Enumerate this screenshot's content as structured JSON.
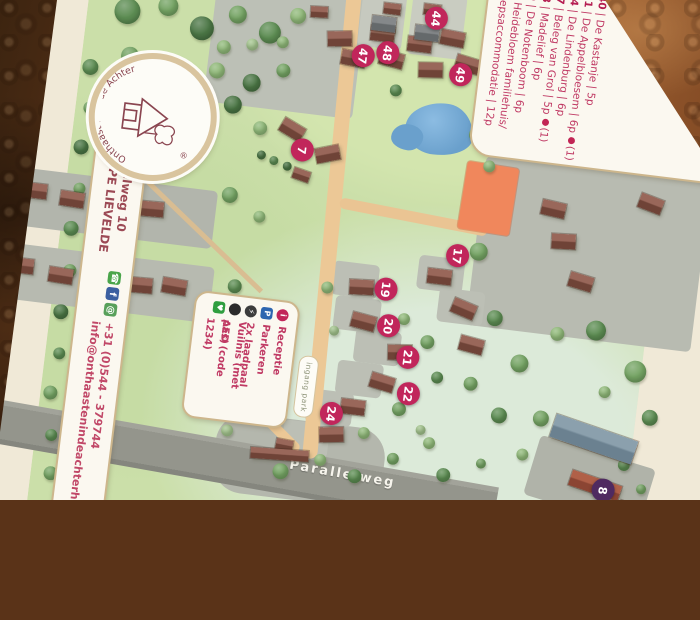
{
  "photo": {
    "surface": "copper leather table"
  },
  "branding": {
    "logo_arc_text": "Onthaast'n in' de Achterhoek",
    "registered_mark": "®"
  },
  "address": {
    "street": "Parallelweg 10",
    "postal_city": "7137 PE LIEVELDE",
    "phone": "+31 (0)544 - 379744",
    "email": "info@onthaastenindeachterhoek.nl"
  },
  "accommodations_legend": {
    "items": [
      {
        "num": "40",
        "name": "De Kastanje",
        "capacity": "5p",
        "pet": false,
        "pet_note": ""
      },
      {
        "num": "41",
        "name": "De Appelbloesem",
        "capacity": "6p",
        "pet": true,
        "pet_note": "(1)"
      },
      {
        "num": "44",
        "name": "De Lindenburg",
        "capacity": "6p",
        "pet": false,
        "pet_note": ""
      },
      {
        "num": "47",
        "name": "Beleg van Grol",
        "capacity": "5p",
        "pet": true,
        "pet_note": "(1)"
      },
      {
        "num": "48",
        "name": "Madelief",
        "capacity": "6p",
        "pet": false,
        "pet_note": ""
      },
      {
        "num": "49",
        "name": "De Notenboom",
        "capacity": "6p",
        "pet": false,
        "pet_note": ""
      },
      {
        "num": "8",
        "name": "Heidebloem familiehuis/ groepsaccommodatie",
        "capacity": "12p",
        "pet": false,
        "pet_note": ""
      }
    ]
  },
  "facilities_legend": {
    "items": [
      {
        "icon": "info-icon",
        "glyph": "i",
        "shape": "circle",
        "color": "#c2265a",
        "label": "Receptie"
      },
      {
        "icon": "parking-icon",
        "glyph": "P",
        "shape": "square",
        "color": "#2e66b0",
        "label": "Parkeren"
      },
      {
        "icon": "ev-charger-icon",
        "glyph": "⚡",
        "shape": "circle",
        "color": "#3c3c3c",
        "label": "2x laadpaal"
      },
      {
        "icon": "trash-icon",
        "glyph": "",
        "shape": "circle",
        "color": "#2b2b2b",
        "label": "Vuilnis (met pas)"
      },
      {
        "icon": "aed-icon",
        "glyph": "♥",
        "shape": "square",
        "color": "#2f9e3f",
        "label": "AED (code 1234)"
      }
    ]
  },
  "map": {
    "road_label": "Parallelweg",
    "entrance_label": "ingang park",
    "marker_color": "#c1265b",
    "marker_8_color": "#4f2a60",
    "markers": [
      {
        "n": "44",
        "x": 407,
        "y": 9
      },
      {
        "n": "47",
        "x": 339,
        "y": 55
      },
      {
        "n": "48",
        "x": 363,
        "y": 49
      },
      {
        "n": "49",
        "x": 438,
        "y": 62
      },
      {
        "n": "7",
        "x": 290,
        "y": 156
      },
      {
        "n": "17",
        "x": 457,
        "y": 242
      },
      {
        "n": "19",
        "x": 390,
        "y": 284
      },
      {
        "n": "20",
        "x": 397,
        "y": 320
      },
      {
        "n": "21",
        "x": 420,
        "y": 349
      },
      {
        "n": "22",
        "x": 425,
        "y": 385
      },
      {
        "n": "24",
        "x": 351,
        "y": 414
      },
      {
        "n": "8",
        "x": 630,
        "y": 457,
        "purple": true
      }
    ],
    "houses": [
      [
        302,
        34,
        -8,
        ""
      ],
      [
        318,
        52,
        4,
        ""
      ],
      [
        344,
        24,
        0,
        ""
      ],
      [
        356,
        48,
        8,
        ""
      ],
      [
        382,
        30,
        0,
        ""
      ],
      [
        396,
        54,
        -6,
        ""
      ],
      [
        414,
        20,
        4,
        ""
      ],
      [
        354,
        0,
        0,
        "small"
      ],
      [
        394,
        -4,
        0,
        "small"
      ],
      [
        432,
        44,
        10,
        ""
      ],
      [
        282,
        12,
        -4,
        "small"
      ],
      [
        344,
        14,
        0,
        "shed"
      ],
      [
        388,
        18,
        0,
        "shed"
      ],
      [
        266,
        130,
        24,
        ""
      ],
      [
        304,
        150,
        -18,
        ""
      ],
      [
        284,
        176,
        12,
        "small"
      ],
      [
        18,
        222,
        0,
        ""
      ],
      [
        56,
        226,
        2,
        ""
      ],
      [
        96,
        229,
        0,
        ""
      ],
      [
        136,
        226,
        -2,
        ""
      ],
      [
        14,
        298,
        0,
        ""
      ],
      [
        54,
        303,
        2,
        ""
      ],
      [
        94,
        306,
        0,
        ""
      ],
      [
        134,
        303,
        -2,
        ""
      ],
      [
        168,
        300,
        3,
        ""
      ],
      [
        527,
        12,
        0,
        ""
      ],
      [
        560,
        40,
        6,
        ""
      ],
      [
        594,
        99,
        4,
        ""
      ],
      [
        535,
        177,
        6,
        ""
      ],
      [
        549,
        208,
        -4,
        ""
      ],
      [
        571,
        246,
        10,
        ""
      ],
      [
        631,
        160,
        14,
        ""
      ],
      [
        354,
        278,
        -4,
        ""
      ],
      [
        360,
        312,
        8,
        ""
      ],
      [
        400,
        338,
        -6,
        ""
      ],
      [
        386,
        370,
        10,
        ""
      ],
      [
        360,
        398,
        0,
        ""
      ],
      [
        342,
        428,
        -8,
        ""
      ],
      [
        300,
        446,
        4,
        "small"
      ],
      [
        430,
        258,
        0,
        ""
      ],
      [
        458,
        287,
        16,
        ""
      ],
      [
        470,
        322,
        8,
        ""
      ],
      [
        276,
        456,
        -3,
        "long"
      ],
      [
        572,
        396,
        12,
        "barn"
      ],
      [
        596,
        446,
        12,
        "red"
      ],
      [
        648,
        468,
        12,
        "red2"
      ]
    ],
    "tree_palette": [
      "#8fb878",
      "#74a363",
      "#5c8c52",
      "#4a7544",
      "#a3c48d"
    ],
    "trees": [
      [
        70,
        100,
        16,
        2
      ],
      [
        74,
        140,
        13,
        1
      ],
      [
        70,
        180,
        15,
        3
      ],
      [
        74,
        222,
        12,
        1
      ],
      [
        70,
        262,
        15,
        2
      ],
      [
        74,
        304,
        13,
        1
      ],
      [
        70,
        346,
        15,
        3
      ],
      [
        74,
        388,
        12,
        2
      ],
      [
        70,
        428,
        14,
        1
      ],
      [
        76,
        470,
        12,
        2
      ],
      [
        80,
        508,
        14,
        1
      ],
      [
        100,
        40,
        26,
        2
      ],
      [
        140,
        30,
        20,
        1
      ],
      [
        176,
        48,
        24,
        3
      ],
      [
        210,
        30,
        18,
        1
      ],
      [
        244,
        44,
        22,
        2
      ],
      [
        270,
        24,
        16,
        0
      ],
      [
        108,
        84,
        18,
        1
      ],
      [
        150,
        96,
        22,
        2
      ],
      [
        196,
        88,
        16,
        0
      ],
      [
        232,
        96,
        18,
        3
      ],
      [
        262,
        80,
        14,
        1
      ],
      [
        120,
        130,
        20,
        2
      ],
      [
        170,
        140,
        16,
        1
      ],
      [
        216,
        120,
        18,
        3
      ],
      [
        246,
        140,
        14,
        0
      ],
      [
        200,
        64,
        14,
        0
      ],
      [
        228,
        58,
        12,
        4
      ],
      [
        258,
        52,
        12,
        0
      ],
      [
        470,
        60,
        18,
        1
      ],
      [
        492,
        92,
        14,
        0
      ],
      [
        376,
        86,
        12,
        2
      ],
      [
        462,
        120,
        16,
        1
      ],
      [
        478,
        150,
        12,
        0
      ],
      [
        250,
        166,
        9,
        3
      ],
      [
        263,
        170,
        9,
        2
      ],
      [
        277,
        174,
        9,
        3
      ],
      [
        224,
        210,
        16,
        1
      ],
      [
        256,
        228,
        12,
        0
      ],
      [
        240,
        300,
        14,
        2
      ],
      [
        216,
        332,
        12,
        1
      ],
      [
        266,
        320,
        10,
        0
      ],
      [
        478,
        236,
        18,
        1
      ],
      [
        502,
        300,
        16,
        2
      ],
      [
        532,
        342,
        18,
        1
      ],
      [
        566,
        308,
        14,
        0
      ],
      [
        604,
        300,
        20,
        2
      ],
      [
        648,
        336,
        22,
        1
      ],
      [
        668,
        380,
        16,
        2
      ],
      [
        620,
        360,
        12,
        0
      ],
      [
        486,
        368,
        14,
        1
      ],
      [
        518,
        396,
        16,
        2
      ],
      [
        332,
        290,
        12,
        0
      ],
      [
        344,
        332,
        10,
        4
      ],
      [
        412,
        312,
        12,
        0
      ],
      [
        438,
        332,
        14,
        1
      ],
      [
        452,
        366,
        12,
        2
      ],
      [
        418,
        402,
        14,
        1
      ],
      [
        386,
        430,
        12,
        0
      ],
      [
        442,
        420,
        10,
        4
      ],
      [
        250,
        380,
        16,
        1
      ],
      [
        232,
        420,
        14,
        2
      ],
      [
        272,
        410,
        10,
        0
      ],
      [
        308,
        478,
        16,
        1
      ],
      [
        346,
        462,
        12,
        0
      ],
      [
        382,
        474,
        14,
        2
      ],
      [
        418,
        452,
        12,
        1
      ],
      [
        452,
        432,
        12,
        0
      ],
      [
        470,
        462,
        14,
        2
      ],
      [
        506,
        446,
        10,
        1
      ],
      [
        546,
        432,
        12,
        0
      ],
      [
        250,
        444,
        12,
        4
      ],
      [
        560,
        394,
        16,
        1
      ],
      [
        648,
        430,
        12,
        2
      ],
      [
        668,
        452,
        10,
        1
      ]
    ]
  }
}
